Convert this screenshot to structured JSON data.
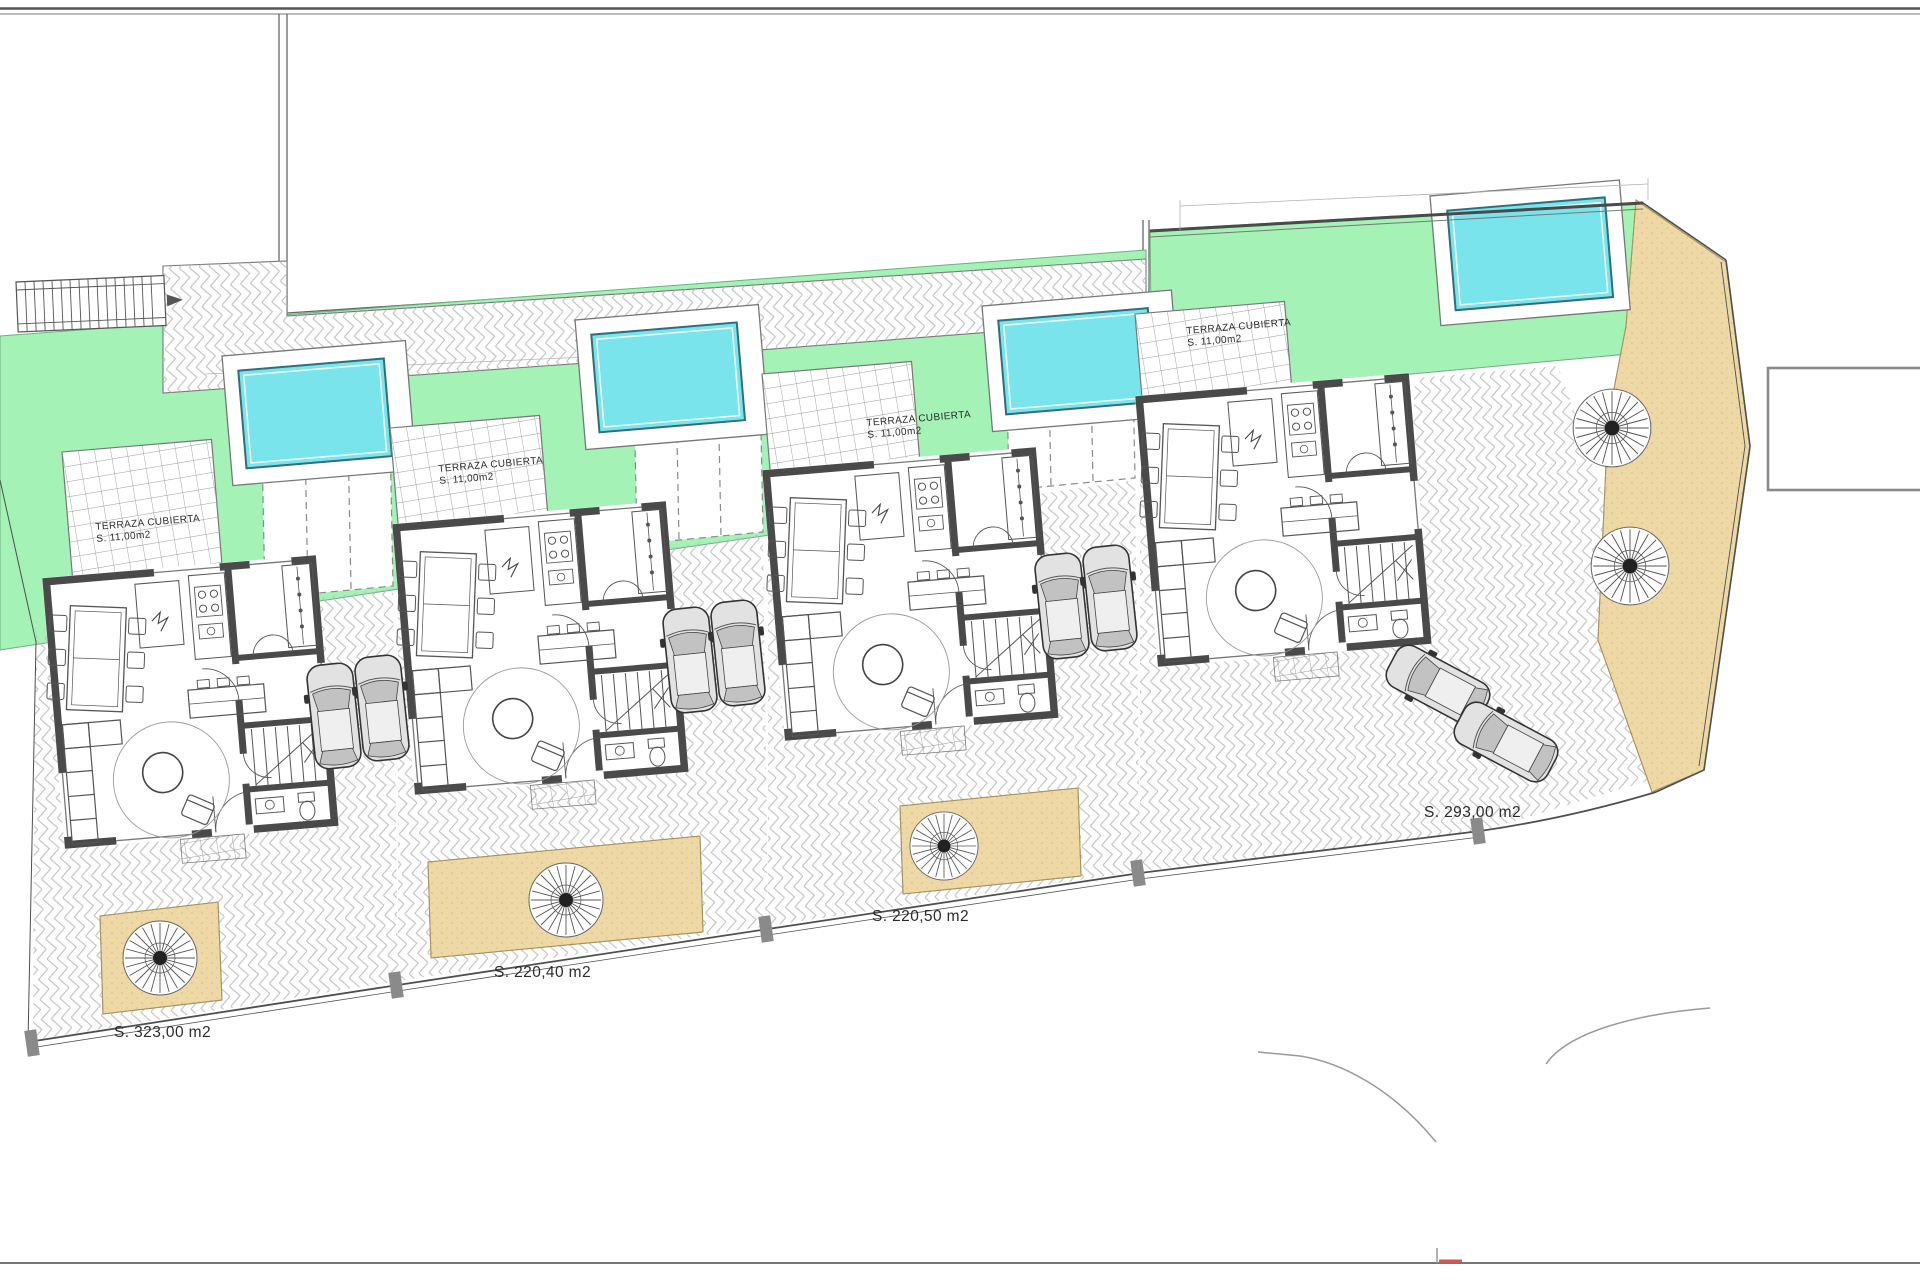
{
  "drawing_labels": {
    "villas": [
      {
        "terrace_title": "TERRAZA CUBIERTA",
        "terrace_area": "S. 11,00m2",
        "plot_area": "S. 323,00 m2"
      },
      {
        "terrace_title": "TERRAZA CUBIERTA",
        "terrace_area": "S. 11,00m2",
        "plot_area": "S. 220,40 m2"
      },
      {
        "terrace_title": "TERRAZA CUBIERTA",
        "terrace_area": "S. 11,00m2",
        "plot_area": "S. 220,50 m2"
      },
      {
        "terrace_title": "TERRAZA CUBIERTA",
        "terrace_area": "S. 11,00m2",
        "plot_area": "S. 293,00 m2"
      }
    ]
  },
  "colors": {
    "green": "#a4f2b6",
    "pool": "#79e4ec",
    "pool_border": "#2f6e7a",
    "sand": "#eed9a6",
    "sand_border": "#a8925e",
    "wall": "#4a4a4a",
    "paving_line": "#bdbdbd",
    "grid_line": "#9a9a9a",
    "boundary": "#4f4f4f",
    "road": "#9a9a9a",
    "red": "#e05252",
    "text": "#2b2b2b",
    "frame": "#555555"
  }
}
